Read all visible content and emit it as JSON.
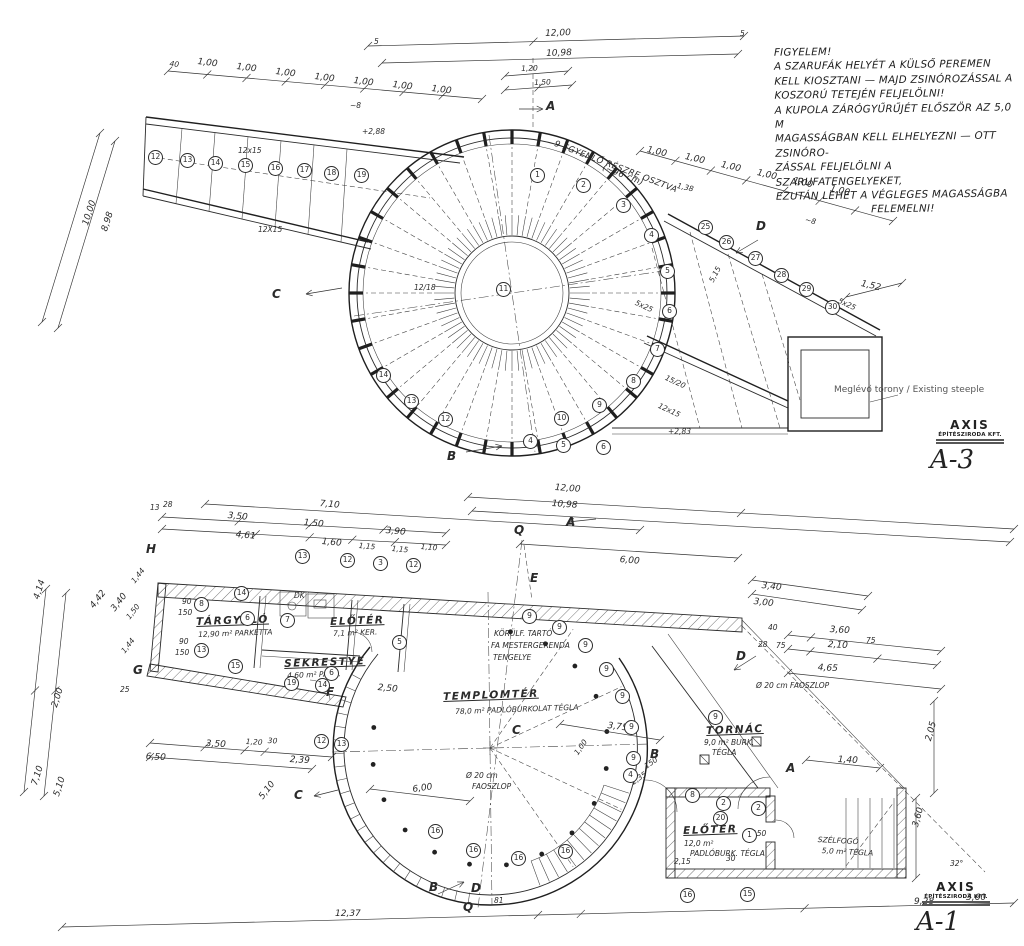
{
  "note": {
    "lines": [
      "FIGYELEM!",
      "A SZARUFÁK HELYÉT A KÜLSŐ PEREMEN",
      "KELL KIOSZTANI — MAJD ZSINÓROZÁSSAL A",
      "KOSZORÚ TETEJÉN FELJELÖLNI!",
      "A KUPOLA ZÁRÓGYŰRŰJÉT ELŐSZÖR AZ 5,0 M",
      "MAGASSÁGBAN KELL ELHELYEZNI — OTT ZSINÓRO-",
      "ZÁSSAL FELJELÖLNI A SZARUFATENGELYEKET,",
      "EZUTÁN LEHET A VÉGLEGES MAGASSÁGBA",
      "FELEMELNI!"
    ]
  },
  "sheets": {
    "top": {
      "brand": "AXIS",
      "firm": "ÉPÍTÉSZIRODA KFT.",
      "number": "A-3"
    },
    "bottom": {
      "brand": "AXIS",
      "firm": "ÉPÍTÉSZIRODA KFT.",
      "number": "A-1"
    }
  },
  "labels": [
    {
      "t": "12,00",
      "x": 545,
      "y": 30,
      "r": -2
    },
    {
      "t": "10,98",
      "x": 546,
      "y": 50,
      "r": -2
    },
    {
      "t": "1,20",
      "x": 521,
      "y": 65,
      "r": -2,
      "c": "dim-sm"
    },
    {
      "t": "1,50",
      "x": 534,
      "y": 79,
      "r": -2,
      "c": "dim-sm"
    },
    {
      "t": "5",
      "x": 374,
      "y": 38,
      "c": "dim-sm"
    },
    {
      "t": "5",
      "x": 740,
      "y": 30,
      "c": "dim-sm"
    },
    {
      "t": "A",
      "x": 546,
      "y": 100,
      "c": "marker"
    },
    {
      "t": "40",
      "x": 170,
      "y": 60,
      "r": 7,
      "c": "dim-sm"
    },
    {
      "t": "1,00",
      "x": 198,
      "y": 58,
      "r": 7
    },
    {
      "t": "1,00",
      "x": 237,
      "y": 63,
      "r": 7
    },
    {
      "t": "1,00",
      "x": 276,
      "y": 68,
      "r": 7
    },
    {
      "t": "1,00",
      "x": 315,
      "y": 73,
      "r": 7
    },
    {
      "t": "1,00",
      "x": 354,
      "y": 77,
      "r": 7
    },
    {
      "t": "1,00",
      "x": 393,
      "y": 81,
      "r": 7
    },
    {
      "t": "1,00",
      "x": 432,
      "y": 85,
      "r": 7
    },
    {
      "t": "~8",
      "x": 350,
      "y": 102,
      "c": "dim-sm"
    },
    {
      "t": "+2,88",
      "x": 362,
      "y": 128,
      "c": "dim-sm"
    },
    {
      "t": "12x15",
      "x": 238,
      "y": 147,
      "c": "dim-sm"
    },
    {
      "t": "12X15",
      "x": 258,
      "y": 226,
      "c": "dim-sm"
    },
    {
      "t": "10,00",
      "x": 82,
      "y": 224,
      "r": -72
    },
    {
      "t": "8,98",
      "x": 101,
      "y": 230,
      "r": -72
    },
    {
      "t": "C",
      "x": 272,
      "y": 288,
      "c": "marker"
    },
    {
      "t": "12/18",
      "x": 414,
      "y": 284,
      "c": "dim-sm"
    },
    {
      "t": "9 EGYENLŐ RÉSZRE OSZTVA",
      "x": 556,
      "y": 140,
      "r": 21,
      "c": "hand-sm"
    },
    {
      "t": "(~96 cm)",
      "x": 604,
      "y": 164,
      "r": 21,
      "c": "hand-sm"
    },
    {
      "t": "1,00",
      "x": 648,
      "y": 146,
      "r": 13
    },
    {
      "t": "1,00",
      "x": 686,
      "y": 153,
      "r": 13
    },
    {
      "t": "1,00",
      "x": 722,
      "y": 161,
      "r": 13
    },
    {
      "t": "1,00",
      "x": 758,
      "y": 169,
      "r": 13
    },
    {
      "t": "1,00",
      "x": 794,
      "y": 177,
      "r": 13
    },
    {
      "t": "1,00",
      "x": 831,
      "y": 185,
      "r": 13
    },
    {
      "t": "1,38",
      "x": 678,
      "y": 182,
      "r": 13,
      "c": "dim-sm"
    },
    {
      "t": "~8",
      "x": 806,
      "y": 216,
      "r": 13,
      "c": "dim-sm"
    },
    {
      "t": "1,52",
      "x": 862,
      "y": 280,
      "r": 13
    },
    {
      "t": "5,15",
      "x": 708,
      "y": 280,
      "r": -62,
      "c": "dim-sm"
    },
    {
      "t": "5x25",
      "x": 637,
      "y": 299,
      "r": 25,
      "c": "dim-sm"
    },
    {
      "t": "5x25",
      "x": 840,
      "y": 297,
      "r": 25,
      "c": "dim-sm"
    },
    {
      "t": "15/20",
      "x": 667,
      "y": 374,
      "r": 25,
      "c": "dim-sm"
    },
    {
      "t": "12x15",
      "x": 660,
      "y": 402,
      "r": 25,
      "c": "dim-sm"
    },
    {
      "t": "+2,83",
      "x": 668,
      "y": 428,
      "c": "dim-sm"
    },
    {
      "t": "D",
      "x": 756,
      "y": 220,
      "c": "marker"
    },
    {
      "t": "B",
      "x": 447,
      "y": 450,
      "c": "marker"
    },
    {
      "t": "11",
      "x": 496,
      "y": 282,
      "c": "circ"
    },
    {
      "t": "1",
      "x": 530,
      "y": 168,
      "c": "circ"
    },
    {
      "t": "2",
      "x": 576,
      "y": 178,
      "c": "circ"
    },
    {
      "t": "3",
      "x": 616,
      "y": 198,
      "c": "circ"
    },
    {
      "t": "4",
      "x": 644,
      "y": 228,
      "c": "circ"
    },
    {
      "t": "5",
      "x": 660,
      "y": 264,
      "c": "circ"
    },
    {
      "t": "6",
      "x": 662,
      "y": 304,
      "c": "circ"
    },
    {
      "t": "7",
      "x": 650,
      "y": 342,
      "c": "circ"
    },
    {
      "t": "8",
      "x": 626,
      "y": 374,
      "c": "circ"
    },
    {
      "t": "9",
      "x": 592,
      "y": 398,
      "c": "circ"
    },
    {
      "t": "10",
      "x": 554,
      "y": 411,
      "c": "circ"
    },
    {
      "t": "12",
      "x": 438,
      "y": 412,
      "c": "circ"
    },
    {
      "t": "13",
      "x": 404,
      "y": 394,
      "c": "circ"
    },
    {
      "t": "14",
      "x": 376,
      "y": 368,
      "c": "circ"
    },
    {
      "t": "12",
      "x": 148,
      "y": 150,
      "c": "circ"
    },
    {
      "t": "13",
      "x": 180,
      "y": 153,
      "c": "circ"
    },
    {
      "t": "14",
      "x": 208,
      "y": 156,
      "c": "circ"
    },
    {
      "t": "15",
      "x": 238,
      "y": 158,
      "c": "circ"
    },
    {
      "t": "16",
      "x": 268,
      "y": 161,
      "c": "circ"
    },
    {
      "t": "17",
      "x": 297,
      "y": 163,
      "c": "circ"
    },
    {
      "t": "18",
      "x": 324,
      "y": 166,
      "c": "circ"
    },
    {
      "t": "19",
      "x": 354,
      "y": 168,
      "c": "circ"
    },
    {
      "t": "25",
      "x": 698,
      "y": 220,
      "c": "circ"
    },
    {
      "t": "26",
      "x": 719,
      "y": 235,
      "c": "circ"
    },
    {
      "t": "27",
      "x": 748,
      "y": 251,
      "c": "circ"
    },
    {
      "t": "28",
      "x": 774,
      "y": 268,
      "c": "circ"
    },
    {
      "t": "29",
      "x": 799,
      "y": 282,
      "c": "circ"
    },
    {
      "t": "30",
      "x": 825,
      "y": 300,
      "c": "circ"
    },
    {
      "t": "4",
      "x": 523,
      "y": 434,
      "c": "circ"
    },
    {
      "t": "5",
      "x": 556,
      "y": 438,
      "c": "circ"
    },
    {
      "t": "6",
      "x": 596,
      "y": 440,
      "c": "circ"
    },
    {
      "t": "Meglévő torony / Existing steeple",
      "x": 834,
      "y": 386,
      "c": "steeple"
    },
    {
      "t": "12,00",
      "x": 555,
      "y": 484,
      "r": 4
    },
    {
      "t": "10,98",
      "x": 552,
      "y": 500,
      "r": 4
    },
    {
      "t": "A",
      "x": 566,
      "y": 516,
      "c": "marker"
    },
    {
      "t": "Q",
      "x": 514,
      "y": 524,
      "c": "marker"
    },
    {
      "t": "E",
      "x": 530,
      "y": 572,
      "c": "marker"
    },
    {
      "t": "6,00",
      "x": 620,
      "y": 556,
      "r": 5
    },
    {
      "t": "7,10",
      "x": 320,
      "y": 500,
      "r": 5
    },
    {
      "t": "13",
      "x": 150,
      "y": 504,
      "c": "dim-sm"
    },
    {
      "t": "28",
      "x": 163,
      "y": 501,
      "c": "dim-sm"
    },
    {
      "t": "3,50",
      "x": 228,
      "y": 512,
      "r": 5
    },
    {
      "t": "1,50",
      "x": 304,
      "y": 519,
      "r": 5
    },
    {
      "t": "3,90",
      "x": 386,
      "y": 527,
      "r": 5
    },
    {
      "t": "4,61",
      "x": 236,
      "y": 531,
      "r": 5
    },
    {
      "t": "1,60",
      "x": 322,
      "y": 538,
      "r": 5
    },
    {
      "t": "1,15",
      "x": 359,
      "y": 542,
      "r": 5,
      "c": "dim-sm"
    },
    {
      "t": "1,15",
      "x": 392,
      "y": 545,
      "r": 5,
      "c": "dim-sm"
    },
    {
      "t": "1,10",
      "x": 421,
      "y": 543,
      "r": 5,
      "c": "dim-sm"
    },
    {
      "t": "H",
      "x": 146,
      "y": 543,
      "c": "marker"
    },
    {
      "t": "G",
      "x": 133,
      "y": 664,
      "c": "marker"
    },
    {
      "t": "F",
      "x": 326,
      "y": 686,
      "c": "marker"
    },
    {
      "t": "4,14",
      "x": 33,
      "y": 598,
      "r": -72
    },
    {
      "t": "4,42",
      "x": 89,
      "y": 605,
      "r": -52
    },
    {
      "t": "3,40",
      "x": 110,
      "y": 608,
      "r": -52
    },
    {
      "t": "1,44",
      "x": 130,
      "y": 580,
      "r": -52,
      "c": "dim-sm"
    },
    {
      "t": "1,50",
      "x": 125,
      "y": 616,
      "r": -52,
      "c": "dim-sm"
    },
    {
      "t": "1,44",
      "x": 120,
      "y": 650,
      "r": -52,
      "c": "dim-sm"
    },
    {
      "t": "25",
      "x": 120,
      "y": 686,
      "c": "dim-sm"
    },
    {
      "t": "2,00",
      "x": 51,
      "y": 706,
      "r": -72
    },
    {
      "t": "7,10",
      "x": 31,
      "y": 784,
      "r": -72
    },
    {
      "t": "5,10",
      "x": 53,
      "y": 795,
      "r": -72
    },
    {
      "t": "90",
      "x": 182,
      "y": 598,
      "c": "dim-sm"
    },
    {
      "t": "150",
      "x": 178,
      "y": 609,
      "c": "dim-sm"
    },
    {
      "t": "90",
      "x": 179,
      "y": 638,
      "c": "dim-sm"
    },
    {
      "t": "150",
      "x": 175,
      "y": 649,
      "c": "dim-sm"
    },
    {
      "t": "TÁRGYALÓ",
      "x": 196,
      "y": 617,
      "r": -2,
      "c": "room"
    },
    {
      "t": "12,90 m² PARKETTA",
      "x": 198,
      "y": 631,
      "r": -2,
      "c": "room-sub"
    },
    {
      "t": "ELŐTÉR",
      "x": 330,
      "y": 617,
      "r": -2,
      "c": "room"
    },
    {
      "t": "7,1 m² KER.",
      "x": 333,
      "y": 630,
      "r": -2,
      "c": "room-sub"
    },
    {
      "t": "DK",
      "x": 294,
      "y": 592,
      "c": "dim-sm"
    },
    {
      "t": "SEKRESTYE",
      "x": 284,
      "y": 659,
      "r": -2,
      "c": "room"
    },
    {
      "t": "4,60 m² PARK.",
      "x": 287,
      "y": 672,
      "r": -2,
      "c": "room-sub"
    },
    {
      "t": "TEMPLOMTÉR",
      "x": 443,
      "y": 692,
      "r": -2,
      "c": "room"
    },
    {
      "t": "78,0 m² PADLÓBURKOLAT TÉGLA",
      "x": 455,
      "y": 708,
      "r": -2,
      "c": "room-sub"
    },
    {
      "t": "KÖRÜLF. TARTÓ",
      "x": 494,
      "y": 630,
      "c": "room-sub"
    },
    {
      "t": "FA MESTERGERENDA",
      "x": 491,
      "y": 642,
      "c": "room-sub"
    },
    {
      "t": "TENGELYE",
      "x": 493,
      "y": 654,
      "c": "room-sub"
    },
    {
      "t": "TORNÁC",
      "x": 706,
      "y": 726,
      "r": -2,
      "c": "room"
    },
    {
      "t": "9,0 m² BURK.",
      "x": 704,
      "y": 739,
      "c": "room-sub"
    },
    {
      "t": "TÉGLA",
      "x": 712,
      "y": 749,
      "c": "room-sub"
    },
    {
      "t": "ELŐTÉR",
      "x": 683,
      "y": 826,
      "r": -2,
      "c": "room"
    },
    {
      "t": "12,0 m²",
      "x": 684,
      "y": 840,
      "c": "room-sub"
    },
    {
      "t": "PADLÓBURK. TÉGLA",
      "x": 690,
      "y": 850,
      "c": "room-sub"
    },
    {
      "t": "SZÉLFOGÓ",
      "x": 818,
      "y": 836,
      "r": 3,
      "c": "room-sub"
    },
    {
      "t": "5,0 m² TÉGLA",
      "x": 822,
      "y": 847,
      "r": 3,
      "c": "room-sub"
    },
    {
      "t": "C",
      "x": 512,
      "y": 724,
      "c": "marker"
    },
    {
      "t": "C",
      "x": 294,
      "y": 789,
      "c": "marker"
    },
    {
      "t": "2,50",
      "x": 378,
      "y": 684,
      "r": 5
    },
    {
      "t": "3,75",
      "x": 608,
      "y": 722,
      "r": 7
    },
    {
      "t": "Ø 20 cm",
      "x": 466,
      "y": 772,
      "c": "dim-sm"
    },
    {
      "t": "FAOSZLOP",
      "x": 472,
      "y": 783,
      "c": "dim-sm"
    },
    {
      "t": "6,00",
      "x": 412,
      "y": 786,
      "r": -8
    },
    {
      "t": "5,10",
      "x": 258,
      "y": 796,
      "r": -52
    },
    {
      "t": "3,50",
      "x": 206,
      "y": 740,
      "r": 3
    },
    {
      "t": "1,20",
      "x": 246,
      "y": 738,
      "r": 3,
      "c": "dim-sm"
    },
    {
      "t": "30",
      "x": 268,
      "y": 737,
      "r": 3,
      "c": "dim-sm"
    },
    {
      "t": "6,50",
      "x": 146,
      "y": 753,
      "r": 3
    },
    {
      "t": "2,39",
      "x": 290,
      "y": 756,
      "r": 3
    },
    {
      "t": "1,00",
      "x": 573,
      "y": 752,
      "r": -55,
      "c": "dim-sm"
    },
    {
      "t": "150",
      "x": 643,
      "y": 764,
      "r": -35,
      "c": "dim-sm"
    },
    {
      "t": "2,35",
      "x": 630,
      "y": 780,
      "r": -35,
      "c": "dim-sm"
    },
    {
      "t": "3,40",
      "x": 762,
      "y": 582,
      "r": 6
    },
    {
      "t": "3,00",
      "x": 754,
      "y": 598,
      "r": 6
    },
    {
      "t": "40",
      "x": 768,
      "y": 624,
      "c": "dim-sm"
    },
    {
      "t": "3,60",
      "x": 830,
      "y": 626,
      "r": 3
    },
    {
      "t": "28",
      "x": 758,
      "y": 641,
      "c": "dim-sm"
    },
    {
      "t": "75",
      "x": 776,
      "y": 642,
      "c": "dim-sm"
    },
    {
      "t": "2,10",
      "x": 828,
      "y": 641,
      "r": 3
    },
    {
      "t": "75",
      "x": 866,
      "y": 637,
      "c": "dim-sm"
    },
    {
      "t": "4,65",
      "x": 818,
      "y": 664,
      "r": 3
    },
    {
      "t": "D",
      "x": 736,
      "y": 650,
      "c": "marker"
    },
    {
      "t": "Ø 20 cm FAOSZLOP",
      "x": 756,
      "y": 682,
      "c": "dim-sm"
    },
    {
      "t": "A",
      "x": 786,
      "y": 762,
      "c": "marker"
    },
    {
      "t": "B",
      "x": 650,
      "y": 748,
      "c": "marker"
    },
    {
      "t": "1,40",
      "x": 838,
      "y": 756,
      "r": 3
    },
    {
      "t": "2,05",
      "x": 925,
      "y": 740,
      "r": -75
    },
    {
      "t": "3,60",
      "x": 912,
      "y": 826,
      "r": -75
    },
    {
      "t": "32°",
      "x": 950,
      "y": 860,
      "c": "dim-sm"
    },
    {
      "t": "12,37",
      "x": 335,
      "y": 910
    },
    {
      "t": "81",
      "x": 494,
      "y": 897,
      "c": "dim-sm"
    },
    {
      "t": "B",
      "x": 429,
      "y": 881,
      "c": "marker"
    },
    {
      "t": "D",
      "x": 471,
      "y": 882,
      "c": "marker"
    },
    {
      "t": "Q",
      "x": 463,
      "y": 901,
      "c": "marker"
    },
    {
      "t": "9,28",
      "x": 914,
      "y": 898
    },
    {
      "t": "3,60",
      "x": 966,
      "y": 894
    },
    {
      "t": "150",
      "x": 752,
      "y": 830,
      "c": "dim-sm"
    },
    {
      "t": "2,15",
      "x": 674,
      "y": 858,
      "c": "dim-sm"
    },
    {
      "t": "30",
      "x": 726,
      "y": 855,
      "c": "dim-sm"
    },
    {
      "t": "13",
      "x": 295,
      "y": 549,
      "c": "circ"
    },
    {
      "t": "12",
      "x": 340,
      "y": 553,
      "c": "circ"
    },
    {
      "t": "3",
      "x": 373,
      "y": 556,
      "c": "circ"
    },
    {
      "t": "12",
      "x": 406,
      "y": 558,
      "c": "circ"
    },
    {
      "t": "14",
      "x": 234,
      "y": 586,
      "c": "circ"
    },
    {
      "t": "8",
      "x": 194,
      "y": 597,
      "c": "circ"
    },
    {
      "t": "6",
      "x": 240,
      "y": 611,
      "c": "circ"
    },
    {
      "t": "7",
      "x": 280,
      "y": 613,
      "c": "circ"
    },
    {
      "t": "13",
      "x": 194,
      "y": 643,
      "c": "circ"
    },
    {
      "t": "15",
      "x": 228,
      "y": 659,
      "c": "circ"
    },
    {
      "t": "6",
      "x": 324,
      "y": 666,
      "c": "circ"
    },
    {
      "t": "19",
      "x": 284,
      "y": 676,
      "c": "circ"
    },
    {
      "t": "14",
      "x": 315,
      "y": 678,
      "c": "circ"
    },
    {
      "t": "5",
      "x": 392,
      "y": 635,
      "c": "circ"
    },
    {
      "t": "12",
      "x": 314,
      "y": 734,
      "c": "circ"
    },
    {
      "t": "13",
      "x": 334,
      "y": 737,
      "c": "circ"
    },
    {
      "t": "9",
      "x": 522,
      "y": 609,
      "c": "circ"
    },
    {
      "t": "9",
      "x": 552,
      "y": 620,
      "c": "circ"
    },
    {
      "t": "9",
      "x": 578,
      "y": 638,
      "c": "circ"
    },
    {
      "t": "9",
      "x": 599,
      "y": 662,
      "c": "circ"
    },
    {
      "t": "9",
      "x": 615,
      "y": 689,
      "c": "circ"
    },
    {
      "t": "9",
      "x": 624,
      "y": 720,
      "c": "circ"
    },
    {
      "t": "9",
      "x": 626,
      "y": 751,
      "c": "circ"
    },
    {
      "t": "9",
      "x": 708,
      "y": 710,
      "c": "circ"
    },
    {
      "t": "4",
      "x": 623,
      "y": 768,
      "c": "circ"
    },
    {
      "t": "16",
      "x": 428,
      "y": 824,
      "c": "circ"
    },
    {
      "t": "16",
      "x": 466,
      "y": 843,
      "c": "circ"
    },
    {
      "t": "16",
      "x": 511,
      "y": 851,
      "c": "circ"
    },
    {
      "t": "16",
      "x": 558,
      "y": 844,
      "c": "circ"
    },
    {
      "t": "8",
      "x": 685,
      "y": 788,
      "c": "circ"
    },
    {
      "t": "2",
      "x": 716,
      "y": 796,
      "c": "circ"
    },
    {
      "t": "2",
      "x": 751,
      "y": 801,
      "c": "circ"
    },
    {
      "t": "20",
      "x": 713,
      "y": 811,
      "c": "circ"
    },
    {
      "t": "1",
      "x": 742,
      "y": 828,
      "c": "circ"
    },
    {
      "t": "16",
      "x": 680,
      "y": 888,
      "c": "circ"
    },
    {
      "t": "15",
      "x": 740,
      "y": 887,
      "c": "circ"
    }
  ]
}
